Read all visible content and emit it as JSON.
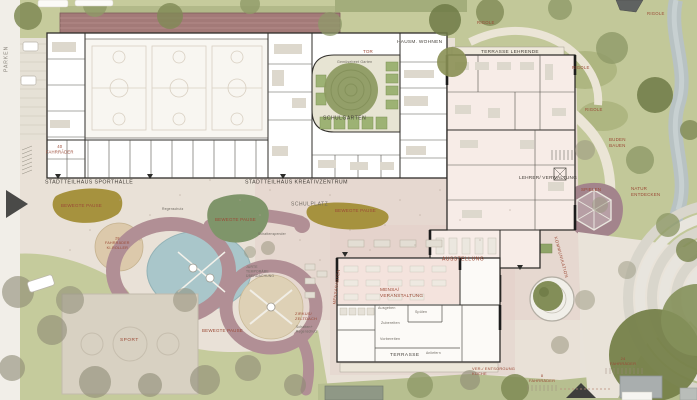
{
  "document": {
    "kind": "architectural site plan (Lageplan, Schulcampus)",
    "language": "German"
  },
  "labels": {
    "parken": "PARKEN",
    "fahrraeder_40": "40\nFAHRRÄDER",
    "sporthalle": "STADTTEILHAUS SPORTHALLE",
    "kreativzentrum": "STADTTEILHAUS KREATIVZENTRUM",
    "schulplatz": "SCHULPLATZ",
    "schulgarten": "SCHULGARTEN",
    "gemuesebeet_garten": "Gemüsebeet Garten",
    "tor": "TOR",
    "hausmeister_wohnen": "HAUSM. WOHNEN",
    "terrasse_lehrende": "TERRASSE LEHRENDE",
    "rigole": "RIGOLE",
    "lehrer_verwaltung": "LEHRER/ VERWALTUNG",
    "buden_bauen": "BUDEN\nBAUEN",
    "spielen": "SPIELEN",
    "natur_entdecken": "NATUR\nENTDECKEN",
    "bewegte_pause": "BEWEGTE PAUSE",
    "kommunikation": "KOMMUNIKATION",
    "ausstellung": "AUSSTELLUNG",
    "mensa_veranstaltung": "MENSA/\nVERANSTALTUNG",
    "mensagarten": "MENSAGARTEN",
    "ausgeben": "Ausgeben",
    "spuelen": "Spülen",
    "zubereiten": "Zubereiten",
    "vorbereiten": "Vorbereiten",
    "anliefern": "Anliefern",
    "terrasse": "TERRASSE",
    "ver_entsorgung_kueche": "VER-/ ENTSORGUNG\nKÜCHE",
    "fahrraeder_8": "8\nFAHRRÄDER",
    "fahrraeder_24": "24\nFAHRRÄDER",
    "fahrraeder_28": "28\nFAHRRÄDER\nKI-ROLLER",
    "sport": "SPORT",
    "zirkus_zeltdach": "ZIRKUS/\nZELTDACH",
    "schatten_regenschutz": "Schatten+\nRegenschutz",
    "jurte": "JURTE\nTEMPORÄRE\nÜBERDACHUNG",
    "regenschutz": "Regenschutz",
    "schattenspender": "Schattenspender"
  },
  "colors": {
    "paper": "#e9e3da",
    "plaza": "#e9e1d7",
    "plaza_pink_tint": "#e3ccc5",
    "grass": "#c5cb9c",
    "park": "#c2c899",
    "running_track": "#a37a78",
    "play_ring_path": "#b18f95",
    "pond_water": "#a9c6ca",
    "sand": "#dcc9ab",
    "olive_pause_area": "#a6923e",
    "sage_pause_area": "#7f956a",
    "spielen_area": "#a3848c",
    "river": "#b7c2c5",
    "building_fill": "#ffffff",
    "building_wall": "#2f2d2a",
    "label_rust": "#9b4a36",
    "label_dark": "#45403a",
    "label_gray": "#6e6961"
  }
}
